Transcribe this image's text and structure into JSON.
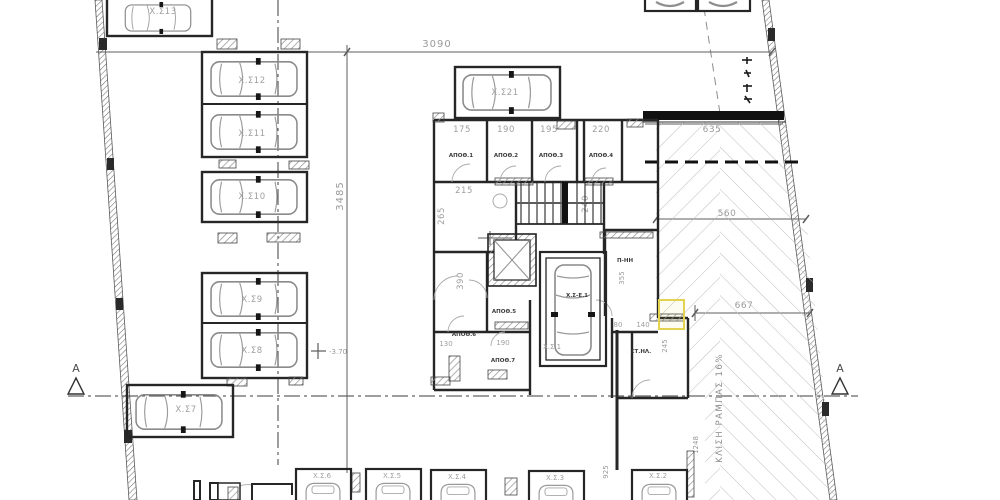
{
  "plan": {
    "section_letter": "Α",
    "ramp_label": "ΚΛΙΣΗ ΡΑΜΠΑΣ 16%",
    "level_mark": "-3.70",
    "stalls": {
      "s13": "Χ.Σ13",
      "s12": "Χ.Σ12",
      "s11": "Χ.Σ11",
      "s10": "Χ.Σ10",
      "s9": "Χ.Σ9",
      "s8": "Χ.Σ8",
      "s7": "Χ.Σ7",
      "s21": "Χ.Σ21",
      "s6": "Χ.Σ.6",
      "s5": "Χ.Σ.5",
      "s4": "Χ.Σ.4",
      "s3": "Χ.Σ.3",
      "s2": "Χ.Σ.2",
      "s1": "Χ.Σ.1",
      "se1": "Χ.Σ-Ε.1"
    },
    "rooms": {
      "ap1": "ΑΠΟΘ.1",
      "ap2": "ΑΠΟΘ.2",
      "ap3": "ΑΠΟΘ.3",
      "ap4": "ΑΠΟΘ.4",
      "ap5": "ΑΠΟΘ.5",
      "ap6": "ΑΠΟΘ.6",
      "ap7": "ΑΠΟΘ.7",
      "mech": "Π-ΗΗ",
      "elec": "ΣΤ.ΗΛ."
    },
    "dims": {
      "overall_w": "3090",
      "overall_h": "3485",
      "ramp_top": "635",
      "ramp_mid": "560",
      "ramp_w": "667",
      "ramp_len": "1248",
      "drive": "925",
      "st1": "175",
      "st2": "190",
      "st3": "195",
      "st4": "220",
      "lobby_w": "215",
      "lobby_h": "265",
      "stair_w": "240",
      "corr_h": "390",
      "b1": "130",
      "b2": "190",
      "mech_h": "355",
      "e1": "80",
      "e2": "140",
      "e3": "245"
    }
  },
  "colors": {
    "highlight": "#e3d34f",
    "walls": "#262626",
    "dims": "#9a9a9a",
    "hatch": "#bbbbbb"
  }
}
